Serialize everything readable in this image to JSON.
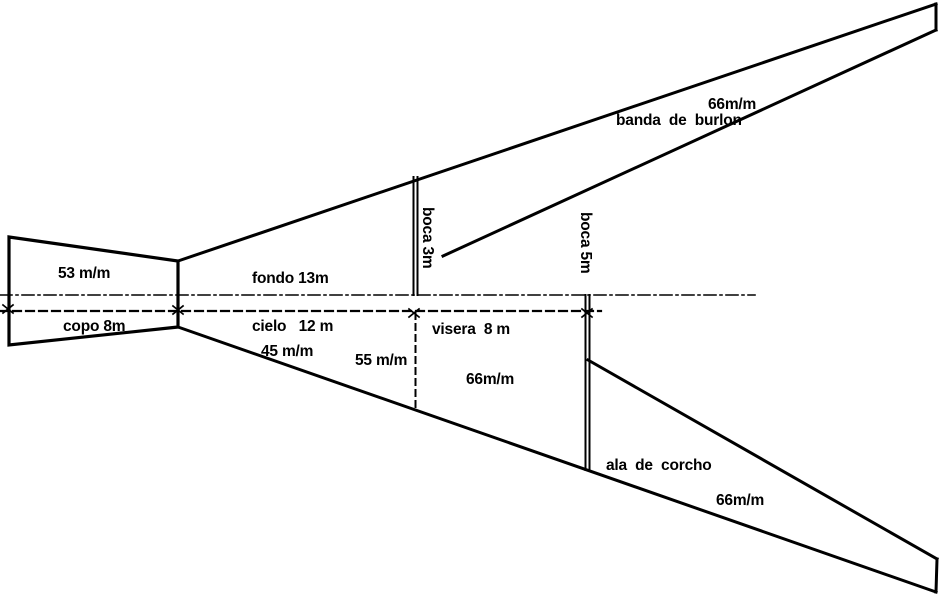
{
  "colors": {
    "ink": "#000000",
    "paper": "#ffffff"
  },
  "labels": {
    "copo_mesh": "53 m/m",
    "copo_length": "copo 8m",
    "fondo_length": "fondo 13m",
    "cielo_length": "cielo   12 m",
    "cielo_mesh": "45 m/m",
    "cielo_mesh_rear": "55 m/m",
    "boca_front": "boca 3m",
    "boca_rear": "boca 5m",
    "visera_length": "visera  8 m",
    "visera_mesh": "66m/m",
    "banda_name": "banda  de  burlon",
    "banda_mesh": "66m/m",
    "ala_name": "ala  de  corcho",
    "ala_mesh": "66m/m"
  }
}
